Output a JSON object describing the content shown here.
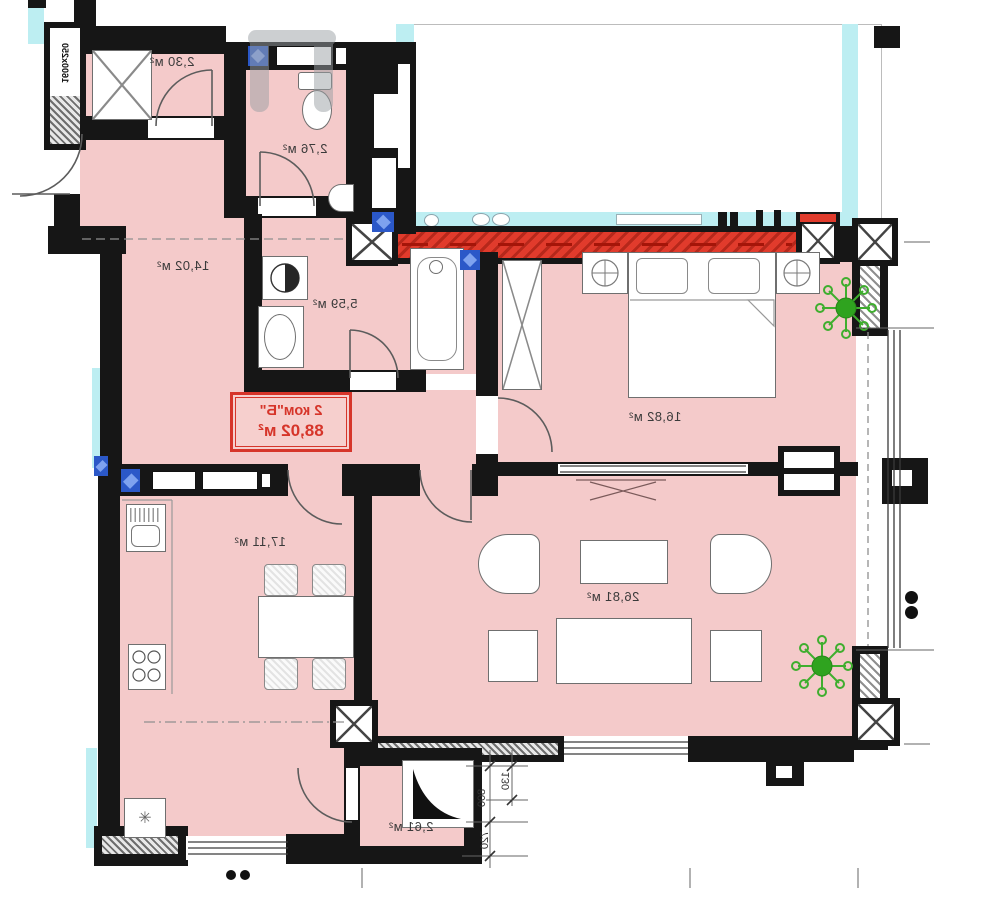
{
  "unit_tag": {
    "line1": "2 ком\"Б\"",
    "line2": "88,02 м²"
  },
  "rooms": {
    "storage": {
      "label": "2,30 м²"
    },
    "wc": {
      "label": "2,76 м²"
    },
    "hallway": {
      "label": "14,02 м²"
    },
    "bathroom": {
      "label": "5,59 м²"
    },
    "bedroom": {
      "label": "16,82 м²"
    },
    "kitchen": {
      "label": "17,11 м²"
    },
    "living_room": {
      "label": "26,81 м²"
    },
    "loggia": {
      "label": "2,61 м²"
    }
  },
  "dimensions": {
    "window_size_label": "1600x250",
    "dim_a": "130",
    "dim_b": "800",
    "dim_c": "720"
  },
  "icons": {
    "fridge_glyph": "✳"
  },
  "colors": {
    "room_fill": "#f4caca",
    "wall": "#161616",
    "accent_red": "#df382b",
    "label_red": "#d6352a",
    "adjacent_cyan": "#bdeef2",
    "plant_green": "#3fae2e",
    "plumbing_blue": "#2b58c8",
    "radiator_wave_cyan": "#6fd3e4"
  }
}
